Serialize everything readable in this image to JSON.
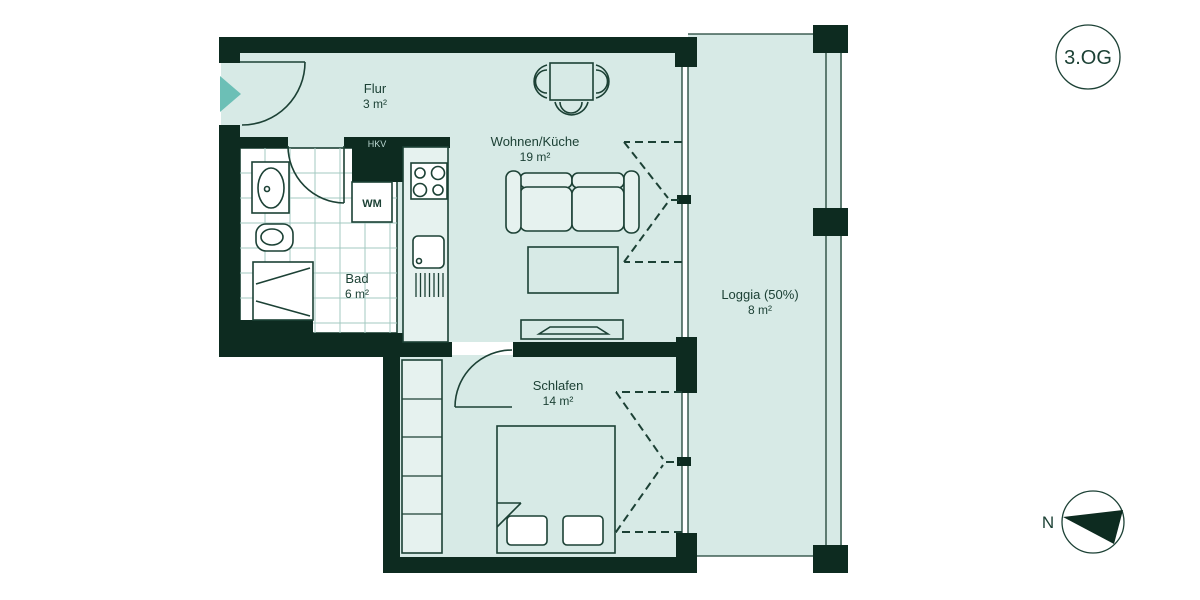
{
  "floor_badge": "3.OG",
  "compass": {
    "label": "N"
  },
  "rooms": {
    "flur": {
      "name": "Flur",
      "area": "3 m²"
    },
    "wohnen": {
      "name": "Wohnen/Küche",
      "area": "19 m²"
    },
    "bad": {
      "name": "Bad",
      "area": "6 m²"
    },
    "schlafen": {
      "name": "Schlafen",
      "area": "14 m²"
    },
    "loggia": {
      "name": "Loggia (50%)",
      "area": "8 m²"
    }
  },
  "fixtures": {
    "hkv_cabinet": "HKV",
    "washing_machine": "WM"
  },
  "colors": {
    "bg": "#ffffff",
    "wall": "#0d2b20",
    "ink": "#1c4135",
    "floor": "#d7eae6",
    "lite": "#e6f2ef",
    "white": "#ffffff",
    "tile": "#a3c8c0",
    "accent": "#6cbfb6",
    "hkvtext": "#bcd9d3"
  }
}
